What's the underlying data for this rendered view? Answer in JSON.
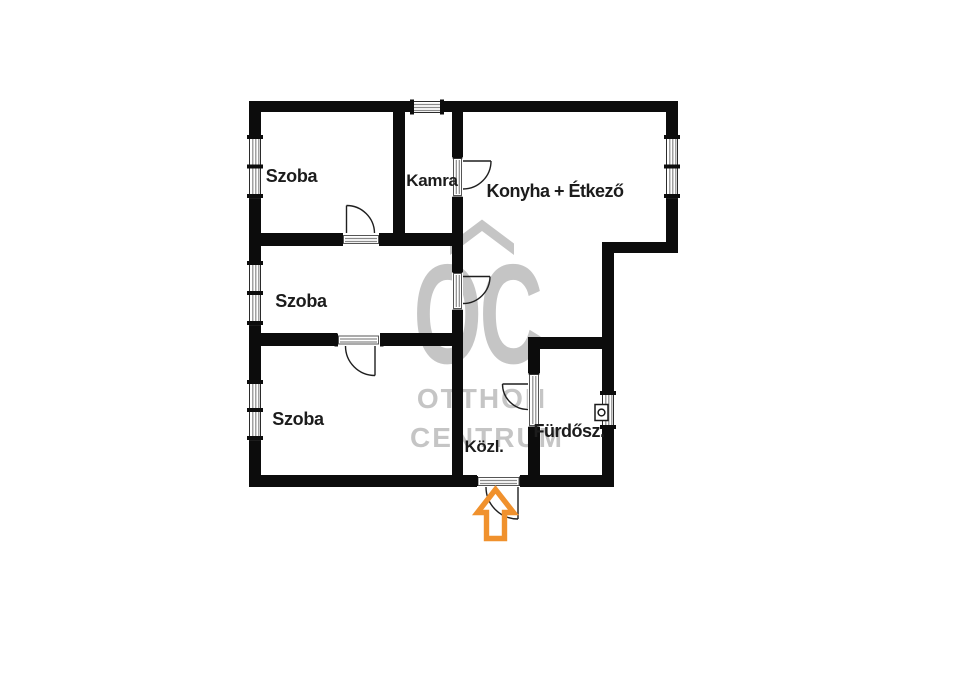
{
  "floorplan": {
    "rooms": [
      {
        "label": "Szoba"
      },
      {
        "label": "Kamra"
      },
      {
        "label": "Konyha + Étkező"
      },
      {
        "label": "Szoba"
      },
      {
        "label": "Szoba"
      },
      {
        "label": "Közl."
      },
      {
        "label": "Fürdősz."
      }
    ],
    "entrance_marker_icon": "arrow-up-icon"
  },
  "watermark": {
    "logo_text": "OC",
    "name_line1": "OTTHON",
    "name_line2": "CENTRUM"
  },
  "colors": {
    "wall_black": "#0c0c0c",
    "label_text": "#1c1c1c",
    "watermark_gray": "#c5c5c5",
    "accent_orange": "#f0912d",
    "hatch_gray": "#8a8a8a"
  }
}
